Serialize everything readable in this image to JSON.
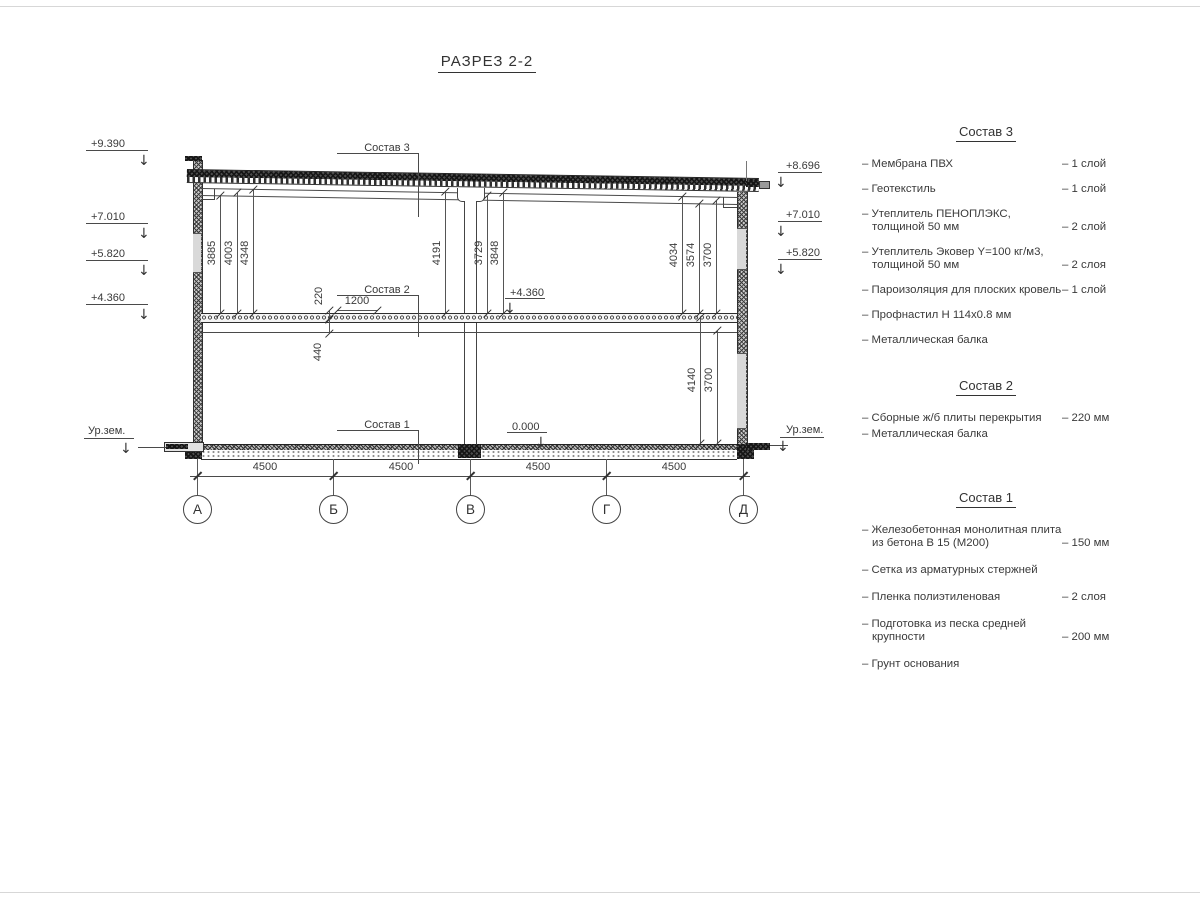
{
  "title": "РАЗРЕЗ 2-2",
  "axes": [
    "А",
    "Б",
    "В",
    "Г",
    "Д"
  ],
  "dims": {
    "upper": [
      "3885",
      "4003",
      "4348",
      "4191",
      "3729",
      "3848",
      "4034",
      "3574",
      "3700"
    ],
    "lower": [
      "440",
      "4140",
      "3700"
    ],
    "slab": [
      "220",
      "1200"
    ],
    "bottom": [
      "4500",
      "4500",
      "4500",
      "4500"
    ]
  },
  "marks": {
    "left": [
      "+9.390",
      "+7.010",
      "+5.820",
      "+4.360"
    ],
    "left_ground": "Ур.зем.",
    "right": [
      "+8.696",
      "+7.010",
      "+5.820"
    ],
    "right_ground": "Ур.зем.",
    "internal_floor": "+4.360",
    "internal_zero": "0.000"
  },
  "callouts": [
    "Состав 3",
    "Состав 2",
    "Состав 1"
  ],
  "legend": {
    "groups": [
      {
        "title": "Состав 3",
        "items": [
          {
            "name": "– Мембрана ПВХ",
            "value": "– 1 слой"
          },
          {
            "name": "– Геотекстиль",
            "value": "– 1 слой"
          },
          {
            "name": "– Утеплитель ПЕНОПЛЭКС, толщиной 50 мм",
            "value": "– 2 слой"
          },
          {
            "name": "– Утеплитель Эковер Y=100 кг/м3, толщиной 50 мм",
            "value": "– 2 слоя"
          },
          {
            "name": "– Пароизоляция для плоских кровель",
            "value": "– 1 слой"
          },
          {
            "name": "– Профнастил Н 114х0.8 мм",
            "value": ""
          },
          {
            "name": "– Металлическая балка",
            "value": ""
          }
        ]
      },
      {
        "title": "Состав 2",
        "items": [
          {
            "name": "– Сборные ж/б плиты перекрытия",
            "value": "– 220 мм"
          },
          {
            "name": "– Металлическая балка",
            "value": ""
          }
        ]
      },
      {
        "title": "Состав 1",
        "items": [
          {
            "name": "– Железобетонная монолитная плита из бетона В 15 (М200)",
            "value": "– 150 мм"
          },
          {
            "name": "– Сетка из арматурных стержней",
            "value": ""
          },
          {
            "name": "– Пленка полиэтиленовая",
            "value": "– 2 слоя"
          },
          {
            "name": "– Подготовка из песка средней крупности",
            "value": "– 200 мм"
          },
          {
            "name": "– Грунт основания",
            "value": ""
          }
        ]
      }
    ]
  },
  "colors": {
    "line": "#444444",
    "text": "#3a3a3a",
    "background": "#ffffff"
  }
}
